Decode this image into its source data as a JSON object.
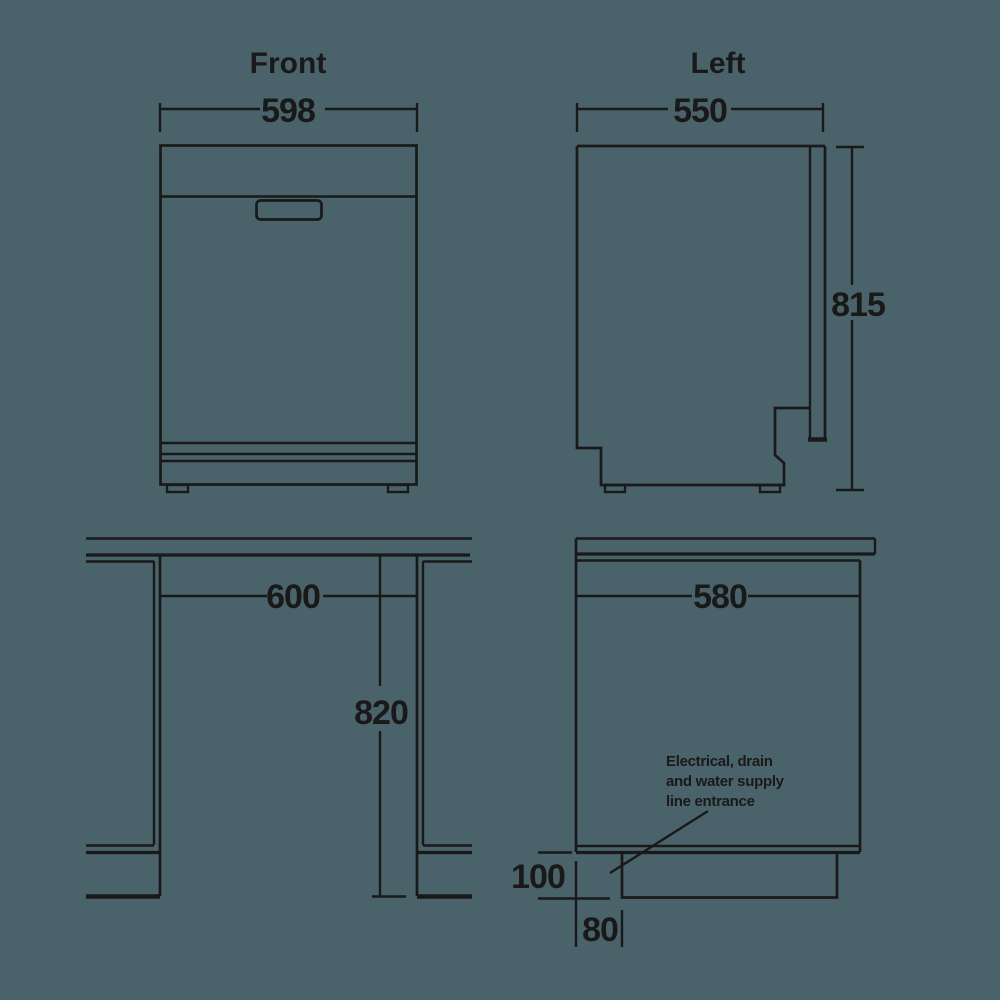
{
  "colors": {
    "bg": "#4a636a",
    "line": "#191919"
  },
  "views": {
    "front": {
      "title": "Front",
      "width": "598"
    },
    "left": {
      "title": "Left",
      "width": "550",
      "height": "815"
    },
    "cutout_front": {
      "width": "600",
      "height": "820"
    },
    "cutout_side": {
      "width": "580",
      "recess_height": "100",
      "recess_inset": "80",
      "callout": {
        "line1": "Electrical, drain",
        "line2": "and water supply",
        "line3": "line entrance"
      }
    }
  }
}
